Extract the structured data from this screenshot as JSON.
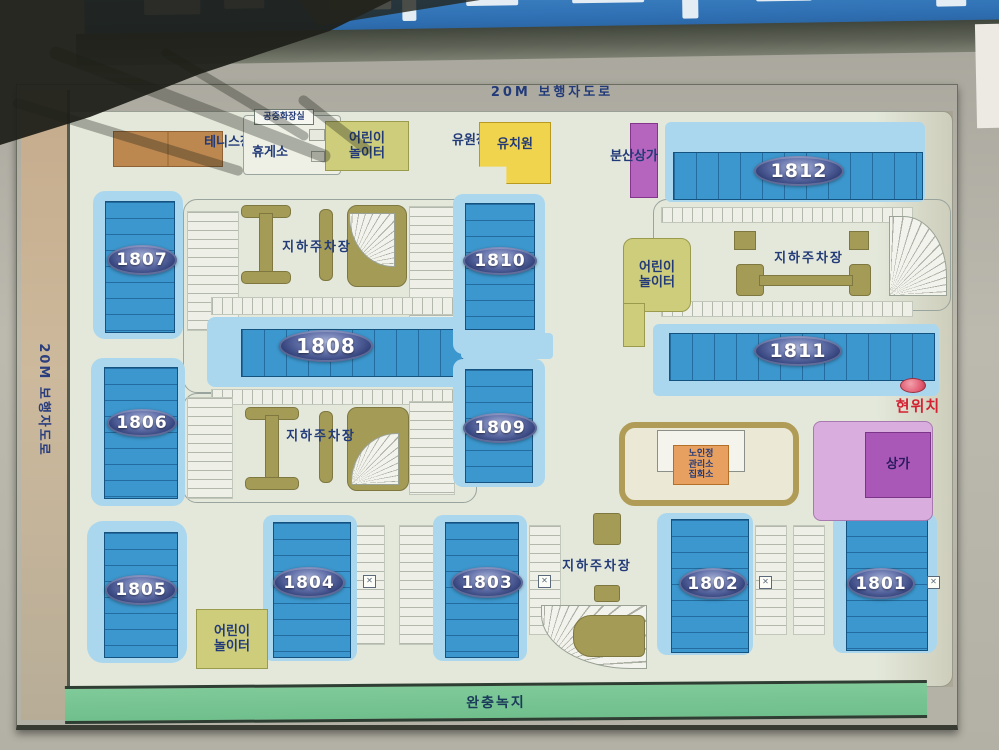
{
  "map": {
    "top_road_label": "20M 보행자도로",
    "left_road_label": "20M 보행자도로",
    "buffer_green_label": "완충녹지",
    "current_location_label": "현위치",
    "underground_parking_label": "지하주차장"
  },
  "facilities": {
    "tennis_court": "테니스장",
    "public_restroom": "공중화장실",
    "rest_area": "휴게소",
    "children_playground_line1": "어린이",
    "children_playground_line2": "놀이터",
    "amusement_ground": "유원장",
    "kindergarten": "유치원",
    "dispersed_shopping": "분산상가",
    "shopping_center": "상가",
    "senior_center_line1": "노인정",
    "senior_center_line2": "관리소",
    "senior_center_line3": "집회소"
  },
  "buildings": {
    "b1801": "1801",
    "b1802": "1802",
    "b1803": "1803",
    "b1804": "1804",
    "b1805": "1805",
    "b1806": "1806",
    "b1807": "1807",
    "b1808": "1808",
    "b1809": "1809",
    "b1810": "1810",
    "b1811": "1811",
    "b1812": "1812"
  },
  "colors": {
    "banner_blue": "#2e6fb2",
    "building_blue": "#3a95cc",
    "building_light_blue": "#abd7ee",
    "parking_ramp_khaki": "#a49b57",
    "playground_olive": "#cdcd7c",
    "kindergarten_yellow": "#f0d44e",
    "dispersed_shop_purple": "#b565be",
    "shop_purple": "#a958b8",
    "buffer_green": "#74c594",
    "current_location_red": "#d42030"
  }
}
